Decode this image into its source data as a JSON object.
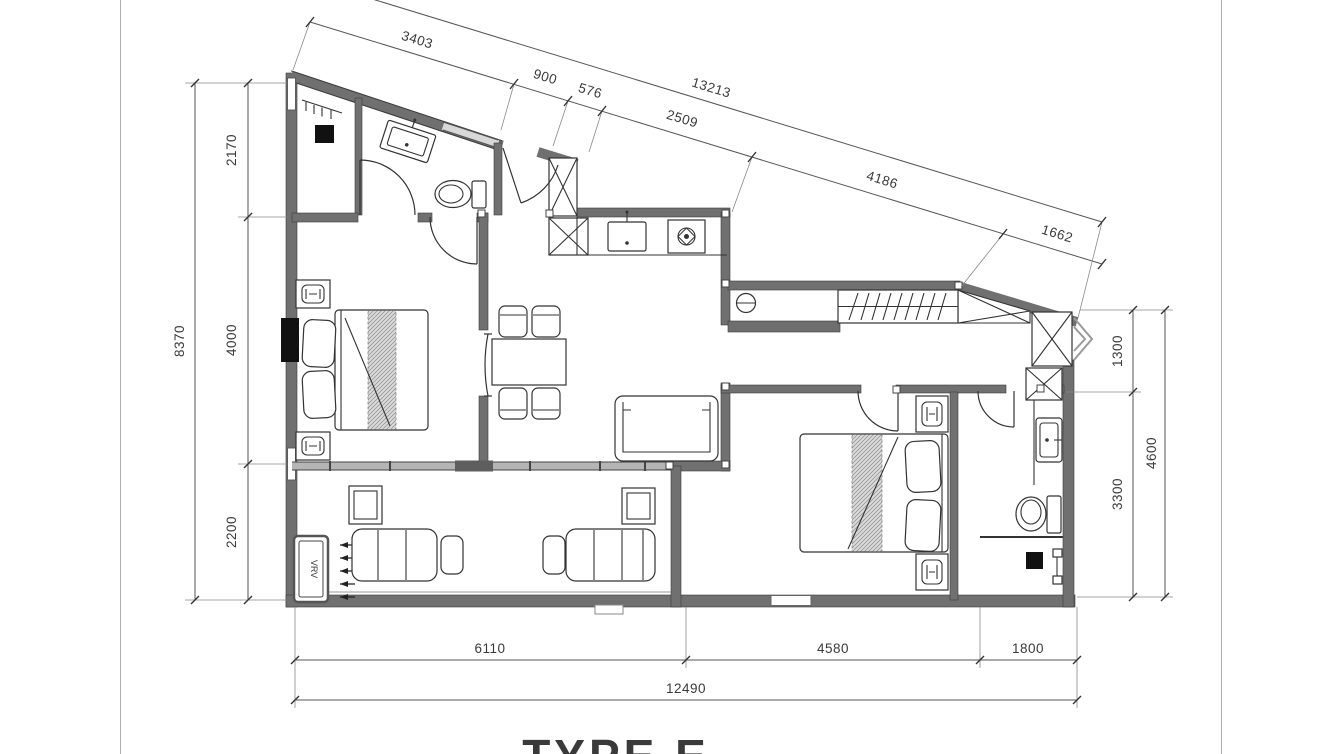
{
  "page": {
    "title": "TYPE E"
  },
  "plan": {
    "vrv_label": "VRV"
  },
  "dims": {
    "top": {
      "total": "13213",
      "segments": [
        "3403",
        "900",
        "576",
        "2509",
        "4186",
        "1662"
      ]
    },
    "left": {
      "total": "8370",
      "segments": [
        "2170",
        "4000",
        "2200"
      ]
    },
    "right": {
      "total": "4600",
      "segments": [
        "1300",
        "3300"
      ]
    },
    "bottom": {
      "total": "12490",
      "segments": [
        "6110",
        "4580",
        "1800"
      ]
    }
  },
  "colors": {
    "wall_gray": "#707070",
    "line_dark": "#333333",
    "dim_line": "#555555",
    "text": "#3a3a3a",
    "fixture_black": "#111111",
    "page_border": "#b0b0b0"
  }
}
